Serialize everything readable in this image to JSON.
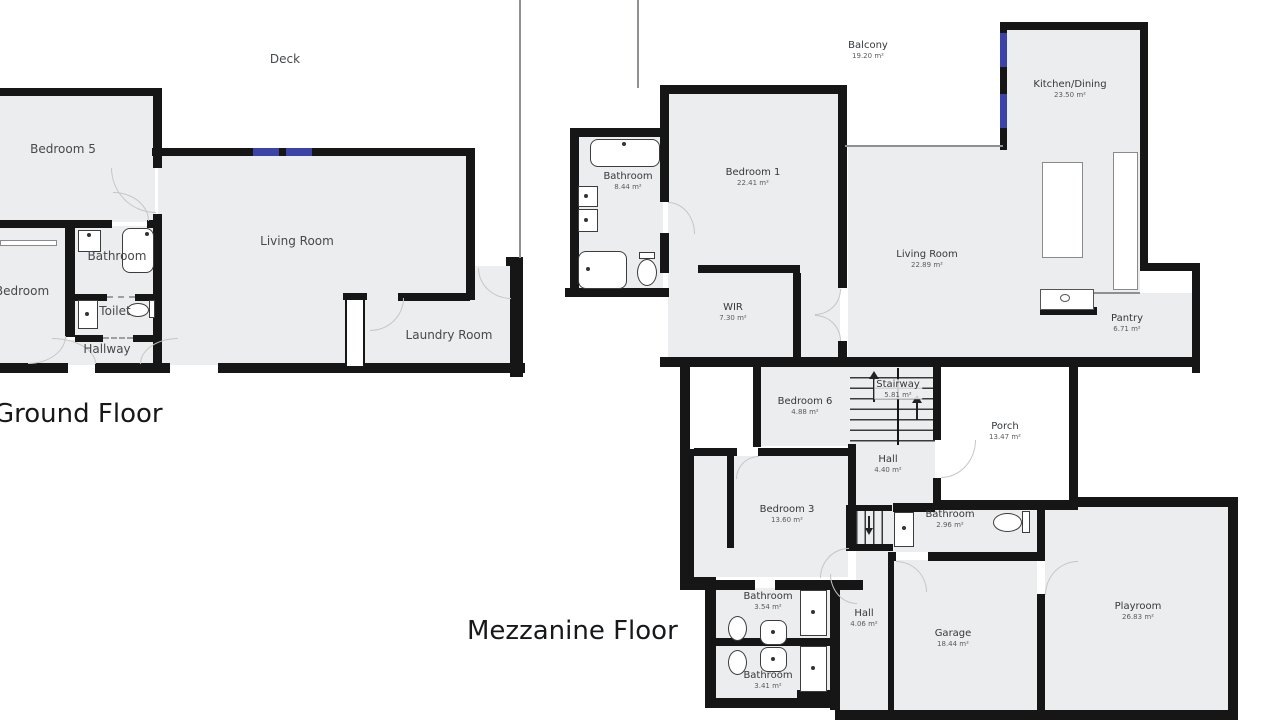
{
  "ground": {
    "title": "Ground Floor",
    "rooms": {
      "deck": "Deck",
      "bedroom5": "Bedroom 5",
      "living": "Living Room",
      "bathroom": "Bathroom",
      "toilet": "Toilet",
      "hallway": "Hallway",
      "bedroom": "Bedroom",
      "laundry": "Laundry Room"
    }
  },
  "mezzanine": {
    "title": "Mezzanine Floor",
    "rooms": {
      "balcony": {
        "name": "Balcony",
        "area": "19.20 m²"
      },
      "kitchen": {
        "name": "Kitchen/Dining",
        "area": "23.50 m²"
      },
      "bedroom1": {
        "name": "Bedroom 1",
        "area": "22.41 m²"
      },
      "bathroom_main": {
        "name": "Bathroom",
        "area": "8.44 m²"
      },
      "living": {
        "name": "Living Room",
        "area": "22.89 m²"
      },
      "wir": {
        "name": "WIR",
        "area": "7.30 m²"
      },
      "pantry": {
        "name": "Pantry",
        "area": "6.71 m²"
      },
      "bedroom6": {
        "name": "Bedroom 6",
        "area": "4.88 m²"
      },
      "stairway": {
        "name": "Stairway",
        "area": "5.81 m²"
      },
      "hall_upper": {
        "name": "Hall",
        "area": "4.40 m²"
      },
      "porch": {
        "name": "Porch",
        "area": "13.47 m²"
      },
      "bedroom3": {
        "name": "Bedroom 3",
        "area": "13.60 m²"
      },
      "bathroom_small": {
        "name": "Bathroom",
        "area": "2.96 m²"
      },
      "bathroom_upper": {
        "name": "Bathroom",
        "area": "3.54 m²"
      },
      "bathroom_lower": {
        "name": "Bathroom",
        "area": "3.41 m²"
      },
      "hall_lower": {
        "name": "Hall",
        "area": "4.06 m²"
      },
      "garage": {
        "name": "Garage",
        "area": "18.44 m²"
      },
      "playroom": {
        "name": "Playroom",
        "area": "26.83 m²"
      }
    }
  },
  "colors": {
    "room_fill": "#ecedee",
    "wall": "#161616",
    "window": "#3c43a8",
    "label": "#34383c",
    "title": "#17181a"
  }
}
